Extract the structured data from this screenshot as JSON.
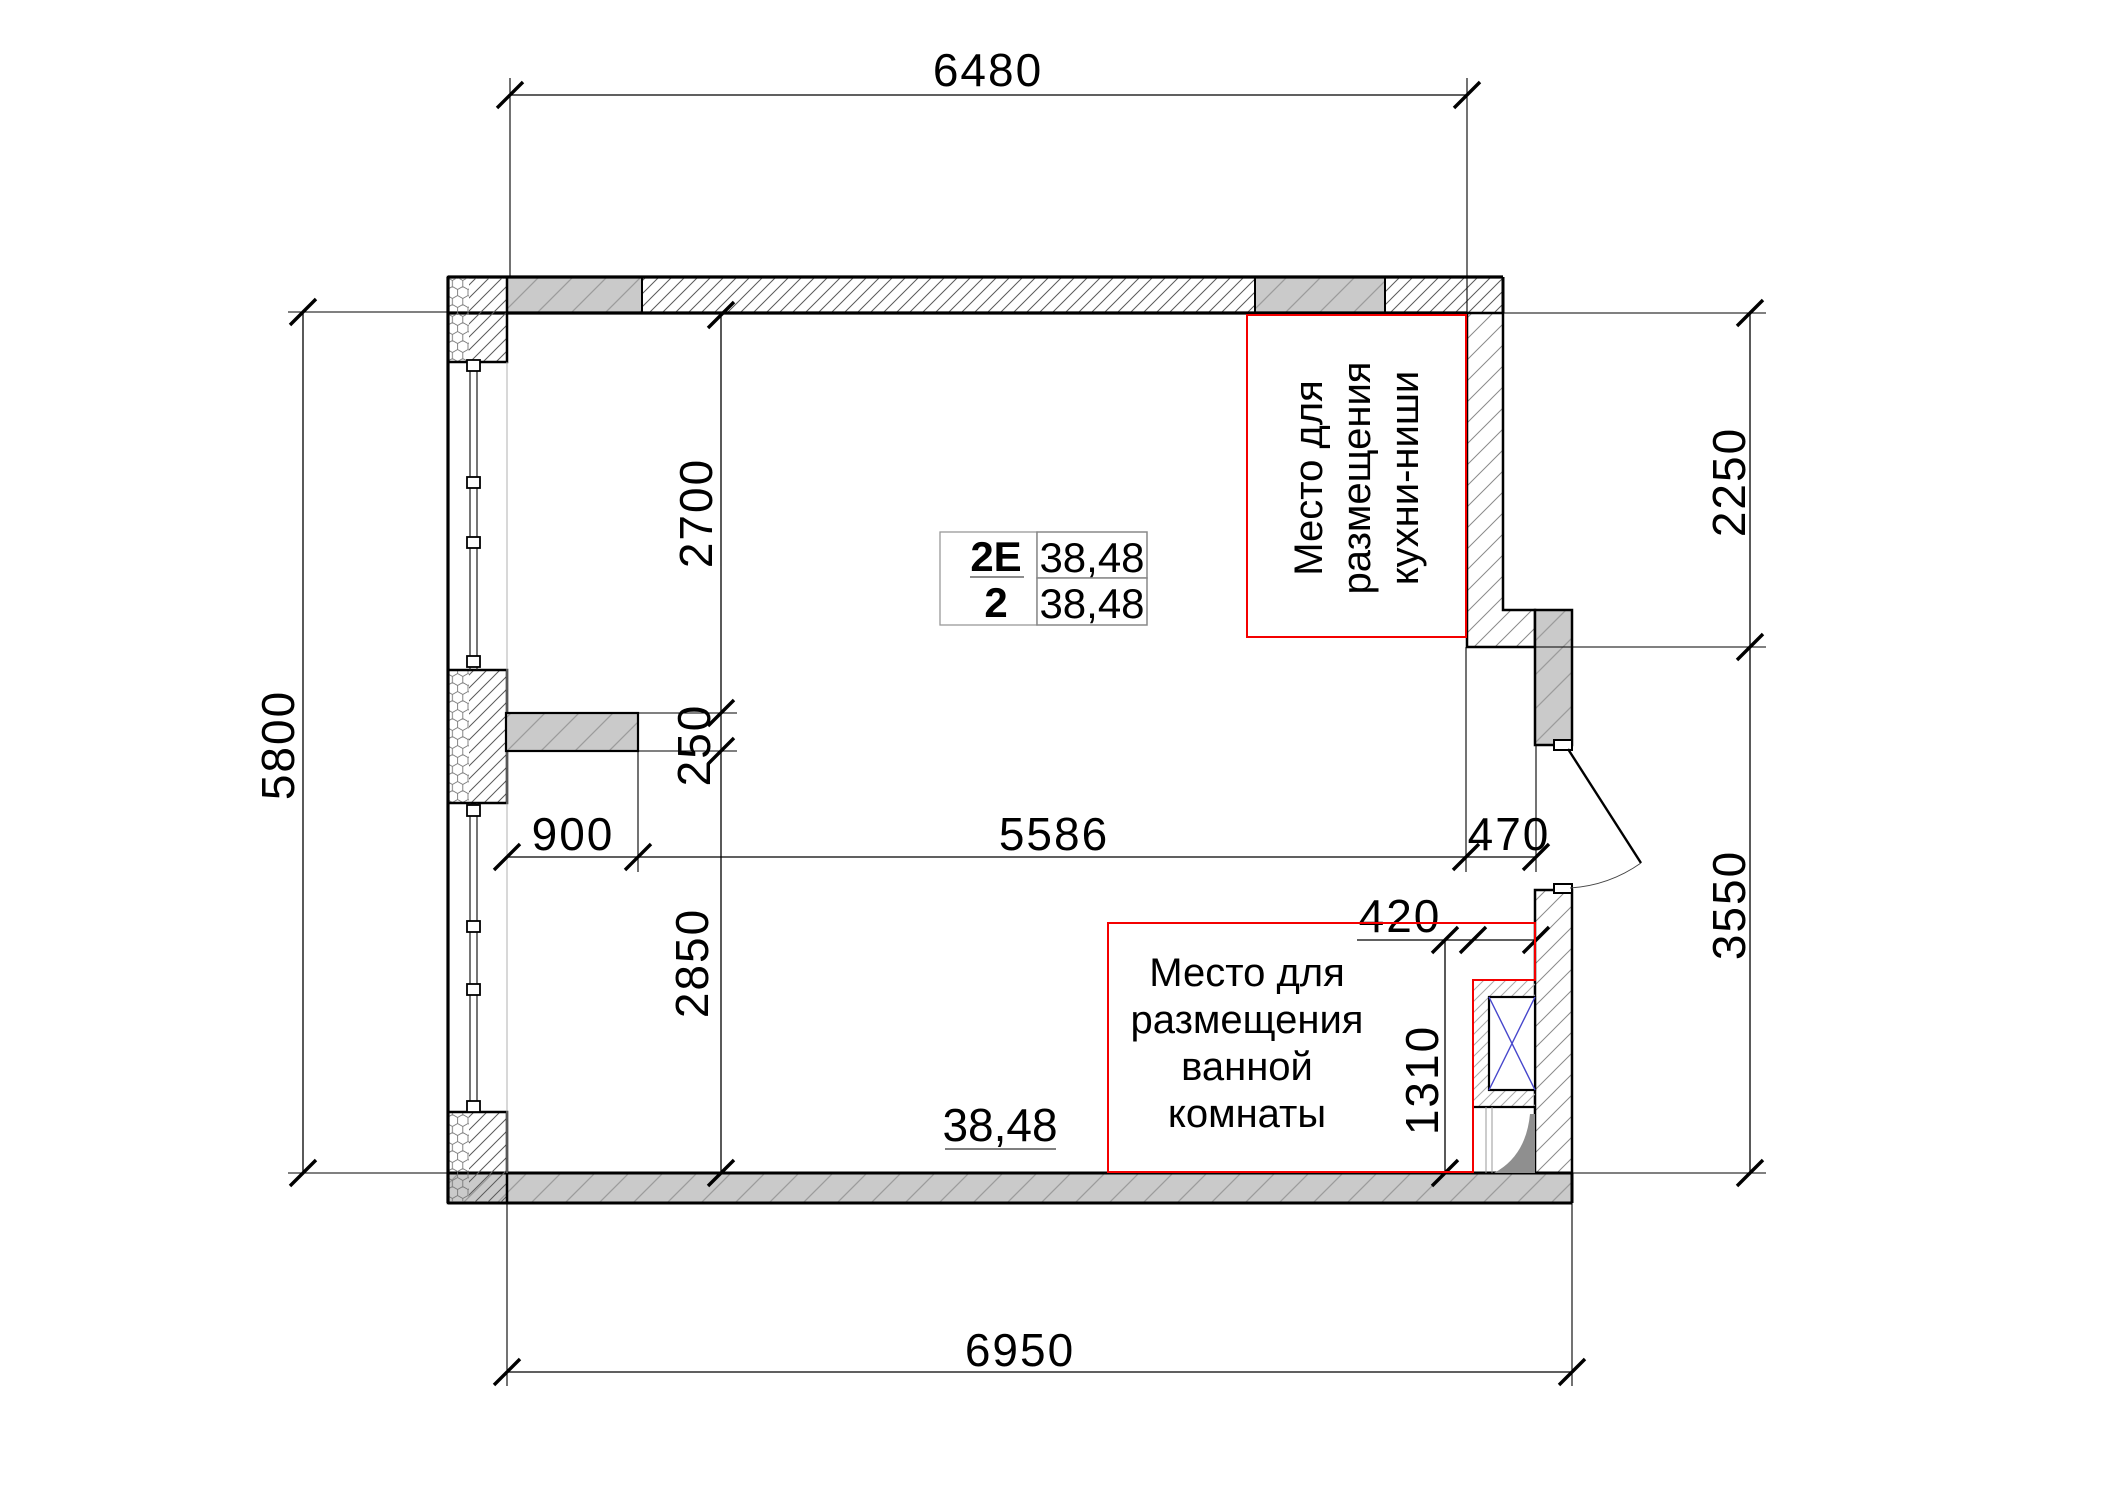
{
  "colors": {
    "red_box": "#f40000",
    "red_text": "#a82424",
    "blue_duct": "#4646cc"
  },
  "dimensions": {
    "top_width": "6480",
    "bottom_width": "6950",
    "left_height": "5800",
    "right_upper": "2250",
    "right_lower": "3550",
    "room_depth_upper": "2700",
    "stub_thickness": "250",
    "room_depth_lower": "2850",
    "stub_length": "900",
    "room_width": "5586",
    "pier_width": "470",
    "bath_offset": "420",
    "bath_duct_height": "1310"
  },
  "unit_label": {
    "unit_type": "2E",
    "rooms": "2",
    "area_total": "38,48",
    "area_living": "38,48"
  },
  "room_area_label": "38,48",
  "zones": {
    "kitchen": {
      "line1": "Место для",
      "line2": "размещения",
      "line3": "кухни-ниши"
    },
    "bath": {
      "line1": "Место для",
      "line2": "размещения",
      "line3": "ванной",
      "line4": "комнаты"
    }
  }
}
